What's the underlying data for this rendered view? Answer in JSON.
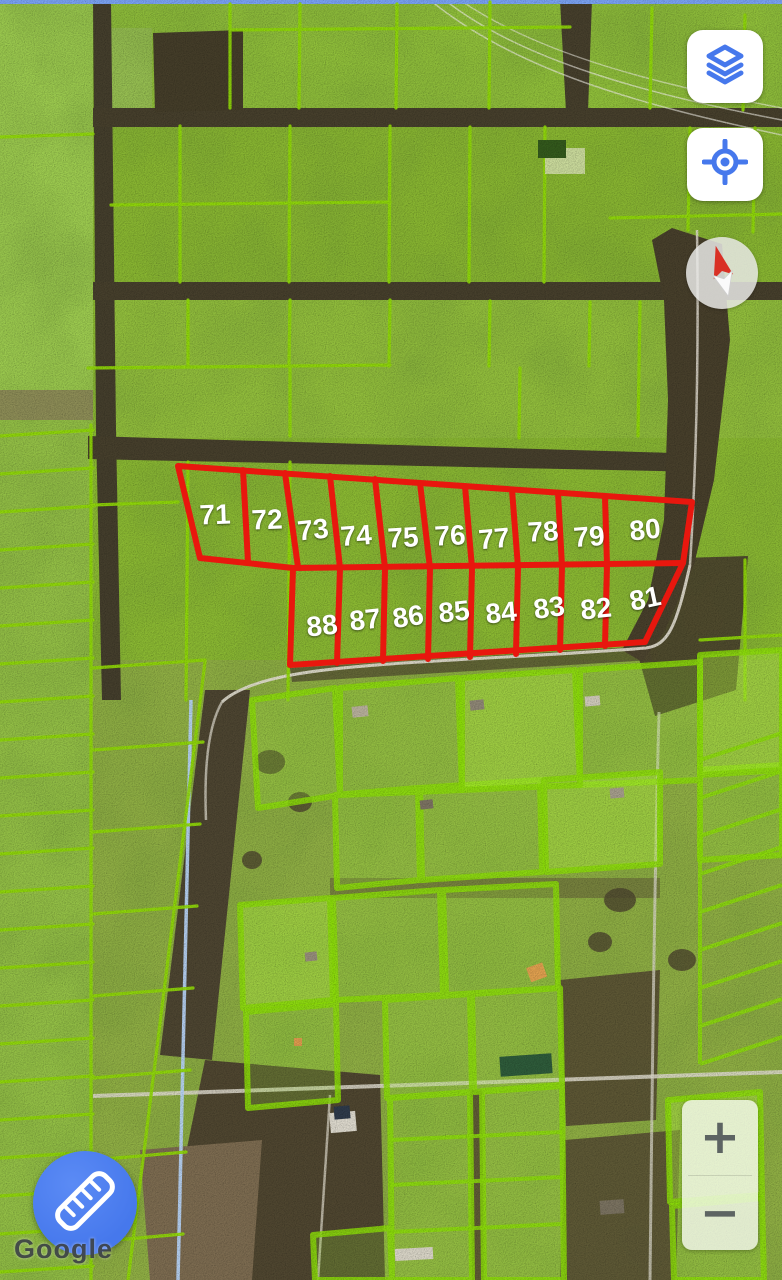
{
  "map": {
    "watermark": "Google",
    "parcel_labels_top": [
      "71",
      "72",
      "73",
      "74",
      "75",
      "76",
      "77",
      "78",
      "79",
      "80"
    ],
    "parcel_labels_bottom": [
      "88",
      "87",
      "86",
      "85",
      "84",
      "83",
      "82",
      "81"
    ],
    "colors": {
      "parcel_line_green": "#8FD806",
      "highlight_red": "#E8170E",
      "parcel_label": "#FFFFFF",
      "accent_blue": "#4678EC"
    },
    "icons": {
      "layers": "layers-icon",
      "my_location": "my-location-icon",
      "compass": "compass-needle-icon",
      "measure": "ruler-icon"
    }
  },
  "controls": {
    "zoom_in_label": "+",
    "zoom_out_label": "−"
  }
}
